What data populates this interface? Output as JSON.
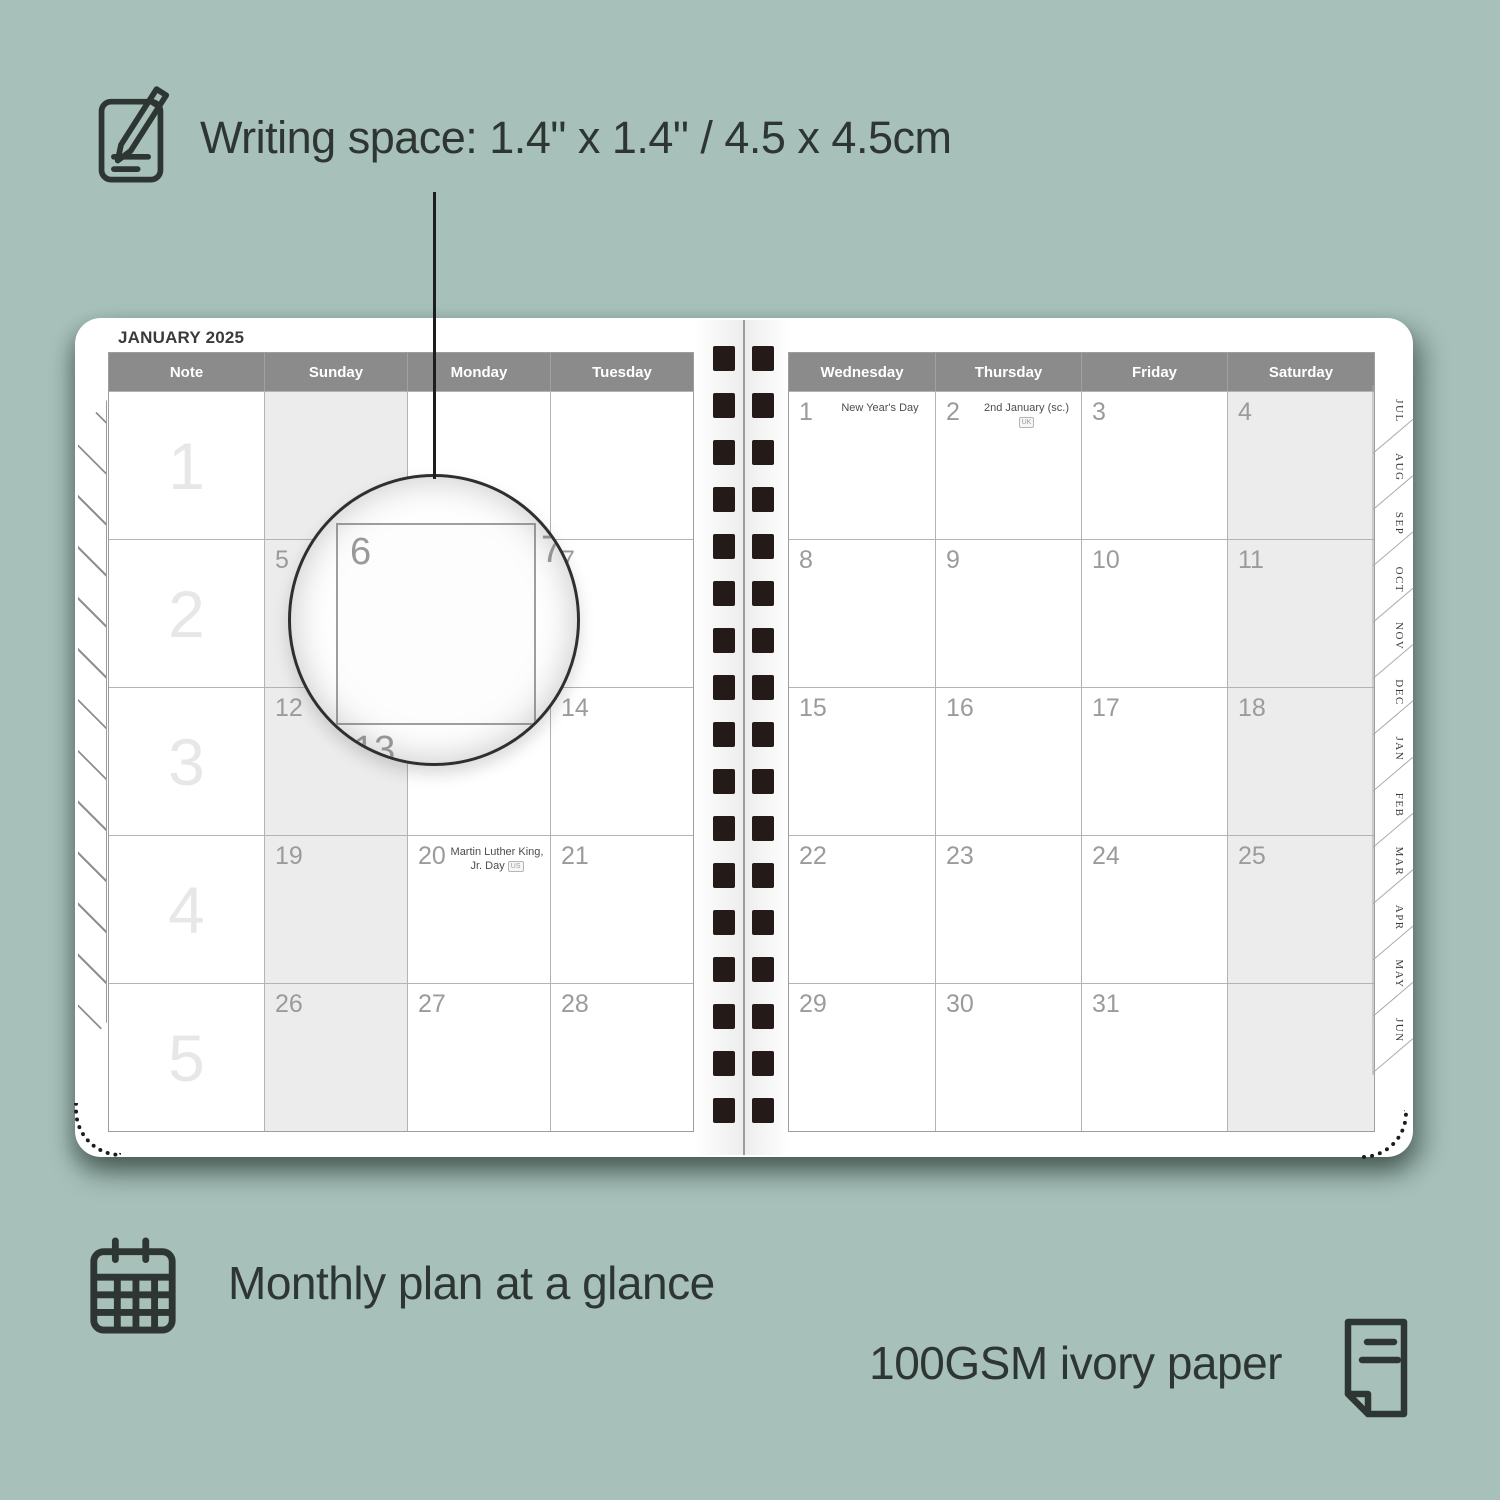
{
  "annotations": {
    "writing_space": "Writing space: 1.4\" x 1.4\" / 4.5 x 4.5cm",
    "monthly_plan": "Monthly plan at a glance",
    "paper": "100GSM ivory paper"
  },
  "planner": {
    "month_title": "JANUARY 2025",
    "left_columns": [
      "Note",
      "Sunday",
      "Monday",
      "Tuesday"
    ],
    "right_columns": [
      "Wednesday",
      "Thursday",
      "Friday",
      "Saturday"
    ],
    "week_numbers": [
      "1",
      "2",
      "3",
      "4",
      "5"
    ],
    "left_weeks": [
      [
        {
          "day": ""
        },
        {
          "day": ""
        },
        {
          "day": ""
        }
      ],
      [
        {
          "day": "5"
        },
        {
          "day": "6"
        },
        {
          "day": "7"
        }
      ],
      [
        {
          "day": "12"
        },
        {
          "day": "13"
        },
        {
          "day": "14"
        }
      ],
      [
        {
          "day": "19"
        },
        {
          "day": "20",
          "holiday": "Martin Luther King, Jr. Day",
          "badge": "US"
        },
        {
          "day": "21"
        }
      ],
      [
        {
          "day": "26"
        },
        {
          "day": "27"
        },
        {
          "day": "28"
        }
      ]
    ],
    "right_weeks": [
      [
        {
          "day": "1",
          "holiday": "New Year's Day"
        },
        {
          "day": "2",
          "holiday": "2nd January (sc.)",
          "badge": "UK"
        },
        {
          "day": "3"
        },
        {
          "day": "4"
        }
      ],
      [
        {
          "day": "8"
        },
        {
          "day": "9"
        },
        {
          "day": "10"
        },
        {
          "day": "11"
        }
      ],
      [
        {
          "day": "15"
        },
        {
          "day": "16"
        },
        {
          "day": "17"
        },
        {
          "day": "18"
        }
      ],
      [
        {
          "day": "22"
        },
        {
          "day": "23"
        },
        {
          "day": "24"
        },
        {
          "day": "25"
        }
      ],
      [
        {
          "day": "29"
        },
        {
          "day": "30"
        },
        {
          "day": "31"
        },
        {
          "day": ""
        }
      ]
    ],
    "tabs": [
      "JUL",
      "AUG",
      "SEP",
      "OCT",
      "NOV",
      "DEC",
      "JAN",
      "FEB",
      "MAR",
      "APR",
      "MAY",
      "JUN"
    ]
  },
  "magnifier": {
    "day": "6",
    "right_day": "7",
    "below_day": "13"
  },
  "colors": {
    "background": "#a7c1ba",
    "ink": "#2e3633",
    "header_gray": "#8b8b8b",
    "weekend_shade": "#ececec",
    "day_number": "#9b9b9b",
    "spiral_hole": "#241a17"
  }
}
